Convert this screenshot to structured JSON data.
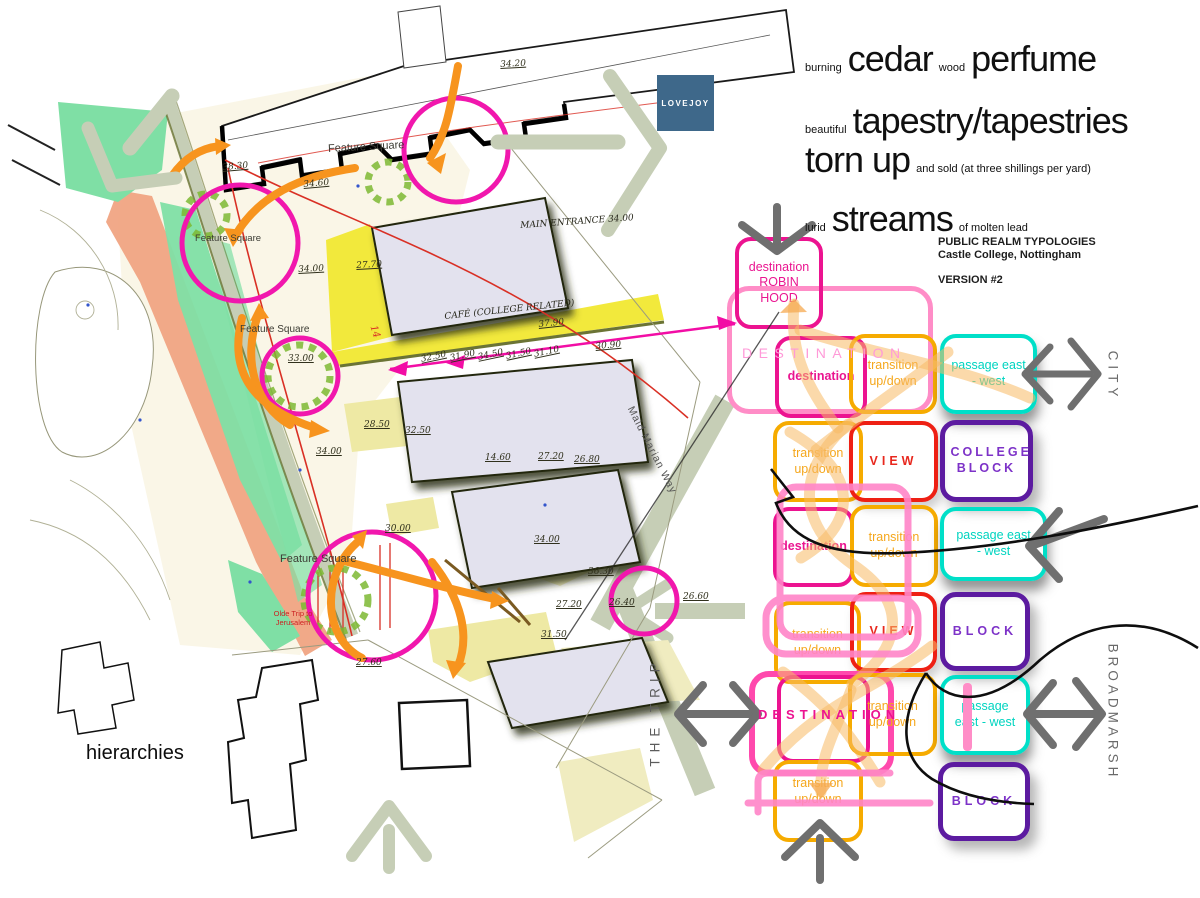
{
  "poem": {
    "l1a": "burning",
    "l1b": "cedar",
    "l1c": "wood",
    "l1d": "perfume",
    "l2a": "beautiful",
    "l2b": "tapestry/tapestries",
    "l3a": "torn up",
    "l3b": "and sold (at three shillings per yard)",
    "l4a": "lurid",
    "l4b": "streams",
    "l4c": "of molten lead"
  },
  "logo": {
    "label": "LOVEJOY"
  },
  "project": {
    "title": "PUBLIC REALM TYPOLOGIES",
    "subtitle": "Castle College, Nottingham",
    "version": "VERSION #2"
  },
  "caption": "hierarchies",
  "edge_labels": {
    "city": "CITY",
    "broadmarsh": "BROADMARSH",
    "the_trip": "THE TRIP",
    "maid_marian_way": "Maid Marian Way"
  },
  "typology": {
    "robin_hood_1": "destination",
    "robin_hood_2": "ROBIN HOOD",
    "destination_lower": "destination",
    "destination_caps": "DESTINATION",
    "transition": "transition up/down",
    "passage": "passage east - west",
    "view": "VIEW",
    "college_block": "COLLEGE BLOCK",
    "block": "BLOCK"
  },
  "map": {
    "feature_square": "Feature Square",
    "main_entrance": "MAIN ENTRANCE  34.00",
    "cafe": "CAFÉ (COLLEGE RELATED)",
    "olde_trip": "Olde Trip to Jerusalem",
    "red_note": "14",
    "levels": [
      {
        "t": "34.20"
      },
      {
        "t": "38.30"
      },
      {
        "t": "34.60"
      },
      {
        "t": "34.00"
      },
      {
        "t": "27.70"
      },
      {
        "t": "33.00"
      },
      {
        "t": "37.90"
      },
      {
        "t": "30.90"
      },
      {
        "t": "32.50"
      },
      {
        "t": "31.90"
      },
      {
        "t": "34.50"
      },
      {
        "t": "31.50"
      },
      {
        "t": "31.10"
      },
      {
        "t": "28.50"
      },
      {
        "t": "32.50"
      },
      {
        "t": "34.00"
      },
      {
        "t": "14.60"
      },
      {
        "t": "27.20"
      },
      {
        "t": "26.80"
      },
      {
        "t": "30.00"
      },
      {
        "t": "34.00"
      },
      {
        "t": "36.30"
      },
      {
        "t": "27.20"
      },
      {
        "t": "26.40"
      },
      {
        "t": "26.60"
      },
      {
        "t": "31.50"
      },
      {
        "t": "27.60"
      }
    ]
  },
  "colors": {
    "magenta": "#ec1390",
    "pink": "#ff8dc7",
    "hot_pink": "#ff49ad",
    "orange": "#f6ab00",
    "peach": "#f8ba64",
    "cyan": "#00dfc8",
    "red": "#ee2014",
    "purple": "#5c1ba0",
    "violet": "#7d32c8",
    "gray_arrow": "#6f6f6f",
    "sage": "#c6ceb6",
    "map_mint": "#7fdfa5",
    "map_salmon": "#f0a483",
    "map_yellow": "#f2e93c",
    "tree_green": "#7cb832",
    "orange_arrow": "#f7941e",
    "lovejoy_blue": "#3e688a"
  }
}
